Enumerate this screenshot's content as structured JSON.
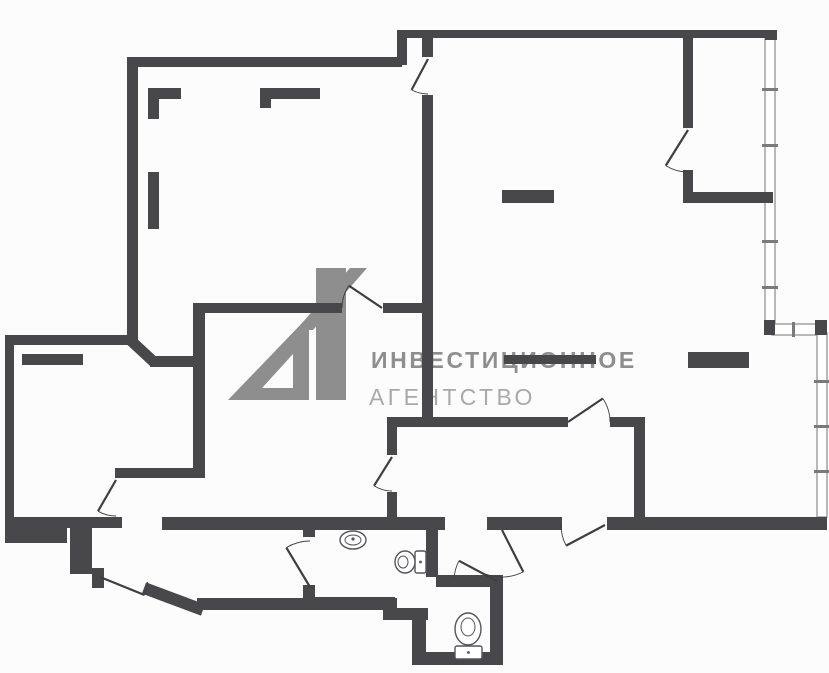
{
  "canvas": {
    "width": 829,
    "height": 673,
    "bg": "#fcfcfc"
  },
  "colors": {
    "wall": "#48484a",
    "thin_line": "#3f3f41",
    "glazing_stroke": "#9b9b9b",
    "glazing_tick": "#7a7a7c",
    "fixture_stroke": "#55555a",
    "watermark_logo": "#8e8e8e",
    "watermark_text_bold": "#8e8e8e",
    "watermark_text_light": "#a9a9a9"
  },
  "watermark": {
    "logo_text": "А1",
    "line1": "ИНВЕСТИЦИОННОЕ",
    "line2": "АГЕНТСТВО"
  },
  "floor_plan": {
    "walls": [
      [
        397,
        30,
        378,
        8
      ],
      [
        397,
        30,
        10,
        35
      ],
      [
        130,
        57,
        272,
        10
      ],
      [
        127,
        57,
        11,
        281
      ],
      [
        422,
        30,
        11,
        27
      ],
      [
        422,
        95,
        11,
        327
      ],
      [
        5,
        335,
        133,
        10
      ],
      [
        5,
        335,
        9,
        196
      ],
      [
        150,
        356,
        50,
        11
      ],
      [
        193,
        303,
        12,
        175
      ],
      [
        193,
        303,
        149,
        10
      ],
      [
        383,
        303,
        39,
        10
      ],
      [
        115,
        468,
        90,
        10
      ],
      [
        5,
        517,
        117,
        11
      ],
      [
        162,
        517,
        283,
        13
      ],
      [
        387,
        417,
        181,
        10
      ],
      [
        610,
        417,
        35,
        10
      ],
      [
        634,
        417,
        11,
        113
      ],
      [
        387,
        417,
        10,
        38
      ],
      [
        387,
        492,
        10,
        38
      ],
      [
        487,
        517,
        75,
        13
      ],
      [
        607,
        517,
        220,
        13
      ],
      [
        683,
        38,
        10,
        90
      ],
      [
        683,
        170,
        10,
        28
      ],
      [
        683,
        192,
        90,
        11
      ],
      [
        5,
        517,
        62,
        26
      ],
      [
        70,
        528,
        22,
        46
      ],
      [
        92,
        568,
        12,
        20
      ],
      [
        197,
        598,
        200,
        12
      ],
      [
        383,
        608,
        45,
        12
      ],
      [
        412,
        612,
        14,
        53
      ],
      [
        412,
        652,
        91,
        13
      ],
      [
        490,
        575,
        13,
        90
      ],
      [
        436,
        575,
        60,
        12
      ],
      [
        426,
        530,
        12,
        47
      ],
      [
        303,
        597,
        92,
        13
      ],
      [
        303,
        517,
        12,
        20
      ],
      [
        303,
        585,
        12,
        18
      ],
      [
        765,
        30,
        12,
        10
      ]
    ],
    "diag_walls": [
      {
        "x1": 127,
        "y1": 337,
        "x2": 155,
        "y2": 363,
        "w": 11
      },
      {
        "x1": 144,
        "y1": 588,
        "x2": 203,
        "y2": 610,
        "w": 12
      }
    ],
    "interior_marks": [
      [
        148,
        88,
        33,
        11
      ],
      [
        148,
        99,
        11,
        20
      ],
      [
        260,
        88,
        60,
        11
      ],
      [
        260,
        99,
        11,
        9
      ],
      [
        148,
        172,
        11,
        57
      ],
      [
        502,
        190,
        52,
        13
      ],
      [
        688,
        352,
        61,
        16
      ],
      [
        22,
        354,
        61,
        11
      ],
      [
        504,
        355,
        92,
        9
      ]
    ],
    "glazing": {
      "segments": [
        [
          765,
          38,
          10,
          286
        ],
        [
          772,
          324,
          45,
          11
        ],
        [
          817,
          333,
          10,
          184
        ]
      ],
      "joints": [
        [
          764,
          320,
          11,
          15
        ],
        [
          815,
          320,
          12,
          15
        ]
      ],
      "ticks": [
        [
          762,
          88,
          16,
          3
        ],
        [
          762,
          144,
          16,
          3
        ],
        [
          762,
          240,
          16,
          3
        ],
        [
          762,
          286,
          16,
          3
        ],
        [
          814,
          380,
          16,
          3
        ],
        [
          814,
          425,
          16,
          3
        ],
        [
          814,
          470,
          16,
          3
        ],
        [
          792,
          322,
          3,
          15
        ]
      ]
    },
    "doors": [
      {
        "hx": 428,
        "hy": 59,
        "r": 35,
        "leaf": 118,
        "wall": 90
      },
      {
        "hx": 688,
        "hy": 130,
        "r": 42,
        "leaf": 122,
        "wall": 90
      },
      {
        "hx": 382,
        "hy": 308,
        "r": 40,
        "leaf": 214,
        "wall": 180
      },
      {
        "hx": 392,
        "hy": 457,
        "r": 34,
        "leaf": 122,
        "wall": 90
      },
      {
        "hx": 568,
        "hy": 422,
        "r": 42,
        "leaf": -34,
        "wall": 0
      },
      {
        "hx": 605,
        "hy": 525,
        "r": 44,
        "leaf": 152,
        "wall": 180
      },
      {
        "hx": 116,
        "hy": 480,
        "r": 36,
        "leaf": 120,
        "wall": 90
      },
      {
        "hx": 310,
        "hy": 587,
        "r": 46,
        "leaf": 239,
        "wall": 270
      },
      {
        "hx": 100,
        "hy": 577,
        "r": 48,
        "leaf": 22,
        "wall": 6
      },
      {
        "hx": 502,
        "hy": 530,
        "r": 47,
        "leaf": 63,
        "wall": 110
      },
      {
        "hx": 497,
        "hy": 581,
        "r": 43,
        "leaf": 208,
        "wall": 185
      }
    ],
    "fixtures": {
      "sink": {
        "cx": 353,
        "cy": 540,
        "rx": 13,
        "ry": 9,
        "irx": 8,
        "iry": 5
      },
      "toilet_right": {
        "bowl": [
          405,
          562,
          10,
          11
        ],
        "inner": [
          403,
          562,
          5,
          6
        ],
        "tank": [
          415,
          551,
          11,
          22
        ]
      },
      "toilet_bottom": {
        "bowl": [
          468,
          629,
          13,
          16
        ],
        "inner": [
          468,
          627,
          7,
          9
        ],
        "tank": [
          455,
          646,
          27,
          13
        ]
      }
    },
    "logo_shapes": {
      "triangle_a": "228,400 304,321 309,321 309,400",
      "notch": "262,388 293,388 293,354",
      "flag": "296,330 350,268 367,268 313,330",
      "one_bar": [
        316,
        268,
        30,
        132
      ]
    }
  }
}
